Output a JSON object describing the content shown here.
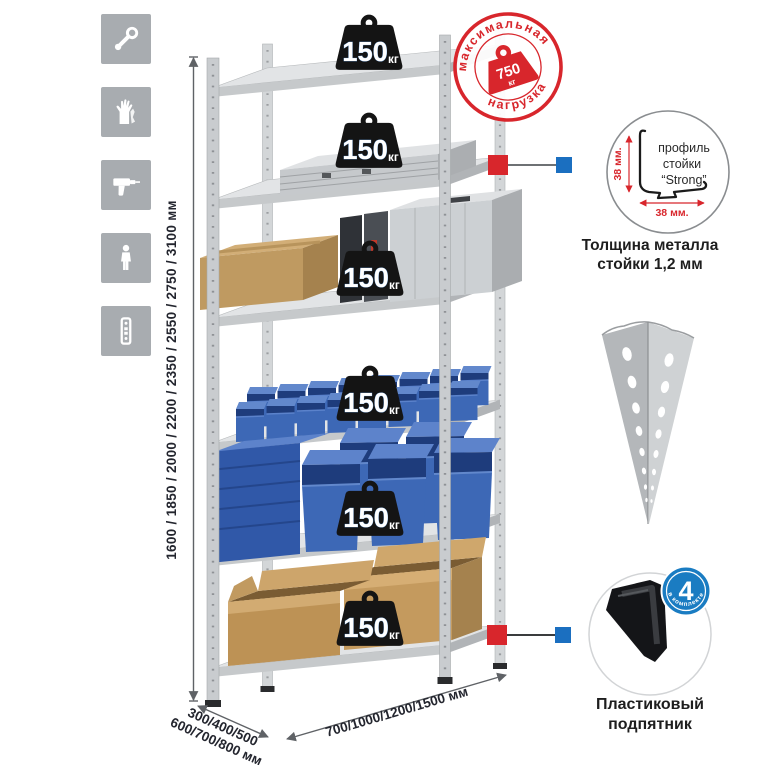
{
  "sidebar": {
    "icons": [
      {
        "name": "wrench-icon"
      },
      {
        "name": "gloves-icon"
      },
      {
        "name": "drill-icon"
      },
      {
        "name": "person-icon"
      },
      {
        "name": "rack-post-icon"
      }
    ]
  },
  "rack": {
    "shelf_count": "6",
    "shelf_load": {
      "value": "150",
      "unit": "кг"
    }
  },
  "stamp": {
    "arc_top": "максимальная",
    "arc_bottom": "нагрузка",
    "weight_value": "750",
    "weight_unit": "кг"
  },
  "dimensions": {
    "height": "1600 / 1850 / 2000 / 2200 / 2350 / 2550 / 2750 / 3100 мм",
    "depth_line1": "300/400/500",
    "depth_line2": "600/700/800 мм",
    "width": "700/1000/1200/1500 мм"
  },
  "profile_callout": {
    "line1": "профиль",
    "line2": "стойки",
    "line3": "“Strong”",
    "dim_vertical": "38 мм.",
    "dim_horizontal": "38 мм.",
    "caption_line1": "Толщина металла",
    "caption_line2": "стойки 1,2 мм"
  },
  "foot_callout": {
    "badge_value": "4",
    "badge_arc": "в комплекте",
    "caption_line1": "Пластиковый",
    "caption_line2": "подпятник"
  },
  "colors": {
    "stamp_red": "#d8262c",
    "connector_red": "#d8262c",
    "connector_blue": "#1b6fc0",
    "bin_blue": "#3d68b6",
    "foot_badge_blue": "#1a7cc2",
    "metal_gray": "#d6d9db",
    "badge_black": "#141414",
    "cardboard": "#bf9a61",
    "tile_gray": "#a8acb0"
  }
}
